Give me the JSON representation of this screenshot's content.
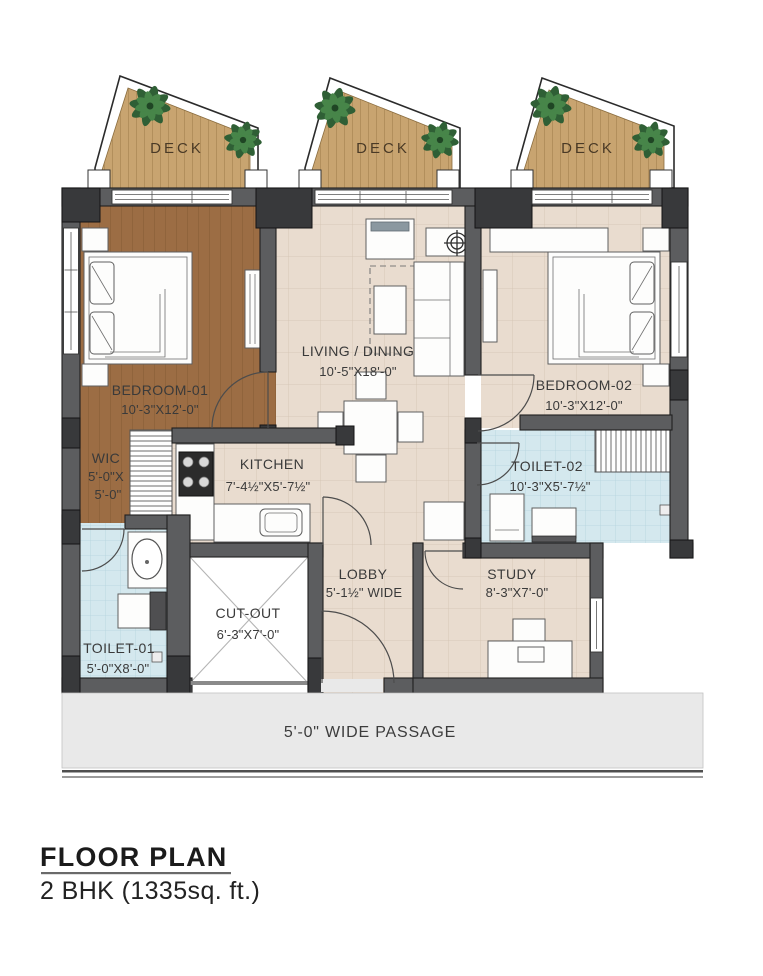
{
  "title": {
    "heading": "FLOOR PLAN",
    "subtitle": "2 BHK (1335sq. ft.)"
  },
  "decks": {
    "d1": "DECK",
    "d2": "DECK",
    "d3": "DECK"
  },
  "rooms": {
    "bedroom1": {
      "name": "BEDROOM-01",
      "dims": "10'-3\"X12'-0\""
    },
    "living": {
      "name": "LIVING / DINING",
      "dims": "10'-5\"X18'-0\""
    },
    "bedroom2": {
      "name": "BEDROOM-02",
      "dims": "10'-3\"X12'-0\""
    },
    "wic": {
      "name": "WIC",
      "dims1": "5'-0\"X",
      "dims2": "5'-0\""
    },
    "kitchen": {
      "name": "KITCHEN",
      "dims": "7'-4½\"X5'-7½\""
    },
    "toilet1": {
      "name": "TOILET-01",
      "dims": "5'-0\"X8'-0\""
    },
    "toilet2": {
      "name": "TOILET-02",
      "dims": "10'-3\"X5'-7½\""
    },
    "cutout": {
      "name": "CUT-OUT",
      "dims": "6'-3\"X7'-0\""
    },
    "lobby": {
      "name": "LOBBY",
      "dims": "5'-1½\" WIDE"
    },
    "study": {
      "name": "STUDY",
      "dims": "8'-3\"X7'-0\""
    },
    "passage": {
      "name": "5'-0\" WIDE PASSAGE"
    }
  },
  "palette": {
    "wall": "#5c5d5f",
    "deck_wood": "#c8a470",
    "bedroom_wood": "#9c6d44",
    "tile_beige": "#e9dccf",
    "tile_blue": "#d4e8ee",
    "passage_gray": "#e9e9e9",
    "plant_green": "#2f5f35",
    "label_text": "#3a3a3a"
  }
}
